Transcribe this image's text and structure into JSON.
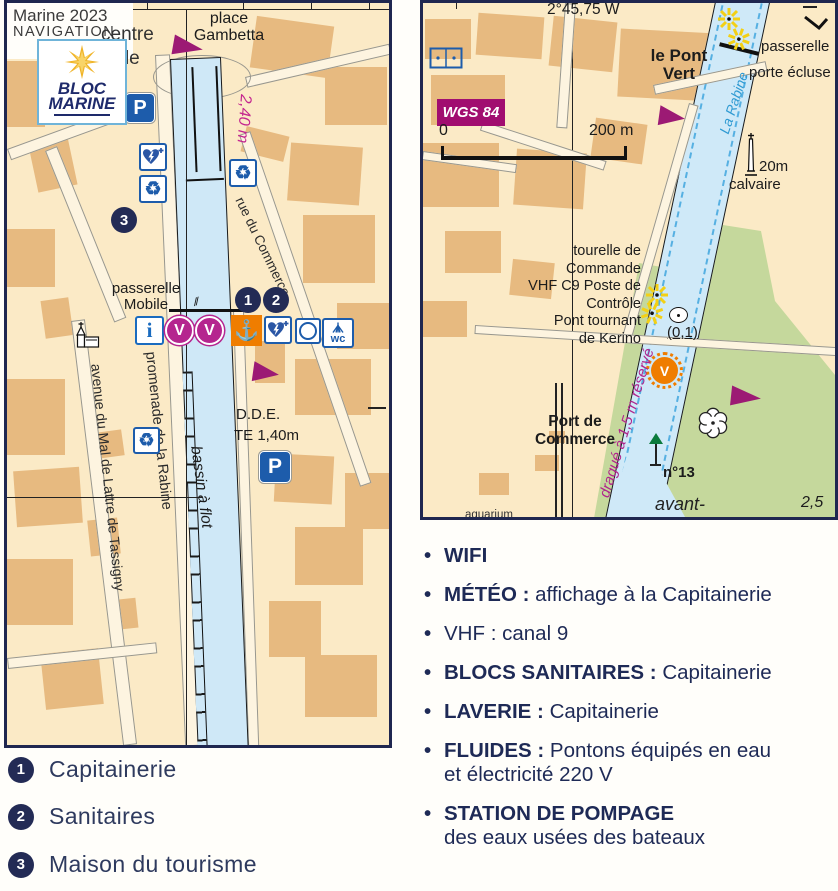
{
  "colors": {
    "navy": "#1f2750",
    "magenta": "#9c1a74",
    "depth_pink": "#c4268f",
    "orange": "#ef7d00",
    "icon_blue": "#1d5cab",
    "water": "#cfe8f7",
    "land": "#fbeac6",
    "building": "#e7ba80",
    "green": "#c5d89c",
    "river_name_blue": "#2f9ad2"
  },
  "header": {
    "edition": "Marine 2023",
    "series": "NAVIGATION"
  },
  "logo": {
    "name_top": "BLOC",
    "name_bottom": "MARINE"
  },
  "left_map": {
    "labels": {
      "centre": "centre",
      "ville": "ville",
      "place_1": "place",
      "place_2": "Gambetta",
      "depth": "2,40 m",
      "rue_commerce": "rue du Commerce",
      "passerelle_1": "passerelle",
      "passerelle_2": "Mobile",
      "promenade": "promenade de la Rabine",
      "avenue": "avenue du Mal de Lattre de Tassigny",
      "bassin": "bassin à flot",
      "dde": "D.D.E.",
      "te": "TE 1,40m"
    },
    "icons": {
      "parking": "P",
      "info": "i",
      "visitor": "V",
      "anchor": "⚓",
      "wc": "wc",
      "recycle": "♻"
    },
    "markers": {
      "m1": "1",
      "m2": "2",
      "m3": "3"
    }
  },
  "right_map": {
    "labels": {
      "longitude": "2°45,75 W",
      "wgs": "WGS 84",
      "scale_zero": "0",
      "scale_end": "200 m",
      "pont_1": "le Pont",
      "pont_2": "Vert",
      "passerelle": "passerelle",
      "porte_ecluse": "porte écluse",
      "rabine": "La Rabine",
      "calvaire_height": "20m",
      "calvaire": "calvaire",
      "tourelle_1": "tourelle de",
      "tourelle_2": "Commande",
      "tourelle_3": "VHF C9 Poste de Contrôle",
      "tourelle_4": "Pont tournant",
      "tourelle_5": "de Kerino",
      "depth_01": "(0,1)",
      "dragues": "dragué à 1,5 m réservé",
      "buoy_v": "V",
      "port_1": "Port de",
      "port_2": "Commerce",
      "beacon": "n°13",
      "avant": "avant-",
      "depth_25": "2,5",
      "aquarium": "aquarium"
    }
  },
  "legend": {
    "items": [
      {
        "num": "1",
        "label": "Capitainerie"
      },
      {
        "num": "2",
        "label": "Sanitaires"
      },
      {
        "num": "3",
        "label": "Maison du tourisme"
      }
    ]
  },
  "services": {
    "items": [
      {
        "label": "WIFI",
        "rest": "",
        "rest2": ""
      },
      {
        "label": "MÉTÉO :",
        "rest": "affichage à la Capitainerie",
        "rest2": ""
      },
      {
        "label": "VHF :",
        "rest": "canal 9",
        "rest2": ""
      },
      {
        "label": "BLOCS SANITAIRES :",
        "rest": "Capitainerie",
        "rest2": ""
      },
      {
        "label": "LAVERIE :",
        "rest": "Capitainerie",
        "rest2": ""
      },
      {
        "label": "FLUIDES :",
        "rest": "Pontons équipés en eau",
        "rest2": "et électricité 220 V"
      },
      {
        "label": "STATION DE POMPAGE",
        "rest": "",
        "rest2": "des eaux usées des bateaux"
      }
    ]
  }
}
